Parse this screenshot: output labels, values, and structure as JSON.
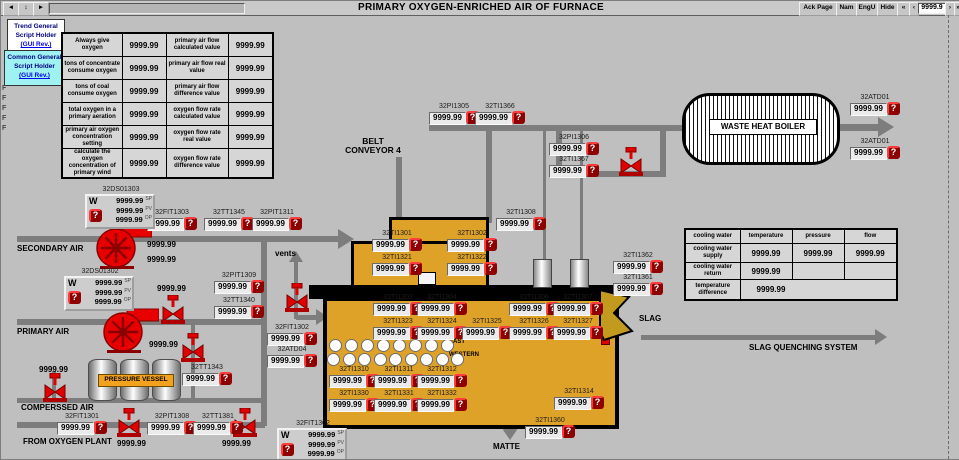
{
  "titlebar": {
    "title": "PRIMARY OXYGEN-ENRICHED AIR OF FURNACE",
    "nav_left": [
      "◄",
      "↕",
      "►"
    ],
    "buttons": [
      "Ack Page",
      "Nam",
      "EngU",
      "Hide"
    ],
    "pager": {
      "first": "«",
      "prev": "‹",
      "value": "9999.9",
      "next": "›",
      "last": "»"
    }
  },
  "script_holders": {
    "trend": {
      "line1": "Trend General",
      "line2": "Script Holder",
      "link": "(GUI Rev.)"
    },
    "common": {
      "line1": "Common General",
      "line2": "Script Holder",
      "link": "(GUI Rev.)"
    }
  },
  "left_mark": "F",
  "oxygen_table": {
    "rows": [
      [
        "Always give oxygen",
        "9999.99",
        "primary air flow calculated value",
        "9999.99"
      ],
      [
        "tons of concentrate consume oxygen",
        "9999.99",
        "primary air flow real value",
        "9999.99"
      ],
      [
        "tons of coal consume oxygen",
        "9999.99",
        "primary air flow difference value",
        "9999.99"
      ],
      [
        "total oxygen in a primary aeration",
        "9999.99",
        "oxygen flow rate calculated value",
        "9999.99"
      ],
      [
        "primary air oxygen concentration setting",
        "9999.99",
        "oxygen flow rate real value",
        "9999.99"
      ],
      [
        "calculate the oxygen concentration of primary wind",
        "9999.99",
        "oxygen flow rate difference value",
        "9999.99"
      ]
    ]
  },
  "cooling_table": {
    "header": [
      "cooling water",
      "temperature",
      "pressure",
      "flow"
    ],
    "rows": [
      [
        "cooling water supply",
        "9999.99",
        "9999.99",
        "9999.99"
      ],
      [
        "cooling water return",
        "9999.99",
        "",
        ""
      ],
      [
        "temperature difference",
        "9999.99",
        "",
        ""
      ]
    ]
  },
  "equipment_labels": {
    "belt_conveyor": "BELT CONVEYOR 4",
    "waste_heat_boiler": "WASTE HEAT BOILER",
    "pressure_vessel": "PRESSURE VESSEL",
    "secondary_air": "SECONDARY AIR",
    "primary_air": "PRIMARY AIR",
    "compressed_air": "COMPERSSED AIR",
    "from_oxygen_plant": "FROM OXYGEN PLANT",
    "vents": "vents",
    "slag": "SLAG",
    "slag_quenching": "SLAG QUENCHING SYSTEM",
    "matte": "MATTE",
    "east": "EAST",
    "western": "WESTERN"
  },
  "alarm_glyph": "?",
  "tags": [
    {
      "label": "32PI1305",
      "value": "9999.99",
      "x": 428,
      "y": 111
    },
    {
      "label": "32TI1366",
      "value": "9999.99",
      "x": 474,
      "y": 111
    },
    {
      "label": "32PI1306",
      "value": "9999.99",
      "x": 548,
      "y": 142
    },
    {
      "label": "32TI1367",
      "value": "9999.99",
      "x": 548,
      "y": 164
    },
    {
      "label": "32ATD01",
      "value": "9999.99",
      "x": 849,
      "y": 102
    },
    {
      "label": "32ATD01",
      "value": "9999.99",
      "x": 849,
      "y": 146
    },
    {
      "label": "32TI1308",
      "value": "9999.99",
      "x": 495,
      "y": 217
    },
    {
      "label": "32FIT1303",
      "value": "9999.99",
      "x": 146,
      "y": 217
    },
    {
      "label": "32TT1345",
      "value": "9999.99",
      "x": 203,
      "y": 217
    },
    {
      "label": "32PIT1311",
      "value": "9999.99",
      "x": 251,
      "y": 217
    },
    {
      "label": "32PIT1309",
      "value": "9999.99",
      "x": 213,
      "y": 280
    },
    {
      "label": "32TT1340",
      "value": "9999.99",
      "x": 213,
      "y": 305
    },
    {
      "label": "32FIT1302",
      "value": "9999.99",
      "x": 266,
      "y": 332
    },
    {
      "label": "32ATD04",
      "value": "9999.99",
      "x": 266,
      "y": 354
    },
    {
      "label": "32TT1343",
      "value": "9999.99",
      "x": 181,
      "y": 372
    },
    {
      "label": "32FIT1301",
      "value": "9999.99",
      "x": 56,
      "y": 421
    },
    {
      "label": "32PIT1308",
      "value": "9999.99",
      "x": 146,
      "y": 421
    },
    {
      "label": "32TT1381",
      "value": "9999.99",
      "x": 192,
      "y": 421
    },
    {
      "label": "32TI1362",
      "value": "9999.99",
      "x": 612,
      "y": 260
    },
    {
      "label": "32TI1361",
      "value": "9999.99",
      "x": 612,
      "y": 282
    },
    {
      "label": "32TI1360",
      "value": "9999.99",
      "x": 524,
      "y": 425
    },
    {
      "label": "32TI1314",
      "value": "9999.99",
      "x": 553,
      "y": 396
    },
    {
      "label": "32TI1301",
      "value": "9999.99",
      "x": 371,
      "y": 238
    },
    {
      "label": "32TI1302",
      "value": "9999.99",
      "x": 446,
      "y": 238
    },
    {
      "label": "32TI1321",
      "value": "9999.99",
      "x": 371,
      "y": 262
    },
    {
      "label": "32TI1322",
      "value": "9999.99",
      "x": 446,
      "y": 262
    },
    {
      "label": "32TI1303",
      "value": "9999.99",
      "x": 372,
      "y": 302
    },
    {
      "label": "32TI1304",
      "value": "9999.99",
      "x": 416,
      "y": 302
    },
    {
      "label": "32TI1306",
      "value": "9999.99",
      "x": 508,
      "y": 302
    },
    {
      "label": "32TI1307",
      "value": "9999.99",
      "x": 552,
      "y": 302
    },
    {
      "label": "32TI1323",
      "value": "9999.99",
      "x": 372,
      "y": 326
    },
    {
      "label": "32TI1324",
      "value": "9999.99",
      "x": 416,
      "y": 326
    },
    {
      "label": "32TI1325",
      "value": "9999.99",
      "x": 461,
      "y": 326
    },
    {
      "label": "32TI1326",
      "value": "9999.99",
      "x": 508,
      "y": 326
    },
    {
      "label": "32TI1327",
      "value": "9999.99",
      "x": 552,
      "y": 326
    },
    {
      "label": "32TI1310",
      "value": "9999.99",
      "x": 328,
      "y": 374
    },
    {
      "label": "32TI1311",
      "value": "9999.99",
      "x": 373,
      "y": 374
    },
    {
      "label": "32TI1312",
      "value": "9999.99",
      "x": 416,
      "y": 374
    },
    {
      "label": "32TI1330",
      "value": "9999.99",
      "x": 328,
      "y": 398
    },
    {
      "label": "32TI1331",
      "value": "9999.99",
      "x": 373,
      "y": 398
    },
    {
      "label": "32TI1332",
      "value": "9999.99",
      "x": 416,
      "y": 398
    }
  ],
  "plain_values": [
    {
      "value": "9999.99",
      "x": 146,
      "y": 239
    },
    {
      "value": "9999.99",
      "x": 146,
      "y": 254
    },
    {
      "value": "9999.99",
      "x": 156,
      "y": 283
    },
    {
      "value": "9999.99",
      "x": 148,
      "y": 339
    },
    {
      "value": "9999.99",
      "x": 38,
      "y": 364
    },
    {
      "value": "9999.99",
      "x": 116,
      "y": 438
    },
    {
      "value": "9999.99",
      "x": 221,
      "y": 438
    }
  ],
  "controllers": [
    {
      "label": "32DS01303",
      "mode": "W",
      "x": 84,
      "y": 193,
      "rows": [
        {
          "v": "9999.99",
          "io": "SP"
        },
        {
          "v": "9999.99",
          "io": "PV"
        },
        {
          "v": "9999.99",
          "io": "OP"
        }
      ]
    },
    {
      "label": "32DS01302",
      "mode": "W",
      "x": 63,
      "y": 275,
      "rows": [
        {
          "v": "9999.99",
          "io": "SP"
        },
        {
          "v": "9999.99",
          "io": "PV"
        },
        {
          "v": "9999.99",
          "io": "OP"
        }
      ]
    },
    {
      "label": "32FIT1302",
      "mode": "W",
      "x": 276,
      "y": 427,
      "rows": [
        {
          "v": "9999.99",
          "io": "SP"
        },
        {
          "v": "9999.99",
          "io": "PV"
        },
        {
          "v": "9999.99",
          "io": "OP"
        }
      ]
    }
  ],
  "tuyeres": {
    "row1": 8,
    "row2": 9
  },
  "colors": {
    "furnace": "#dfa228",
    "pipe": "#7d7d7d",
    "equipment_red": "#e00000",
    "alarm_bg": "#8c0000",
    "alarm_border": "#ff3b3b",
    "slag_chute": "#c29b1e",
    "holder_trend_bg": "#ffffff",
    "holder_common_bg": "#9ff2f2"
  }
}
